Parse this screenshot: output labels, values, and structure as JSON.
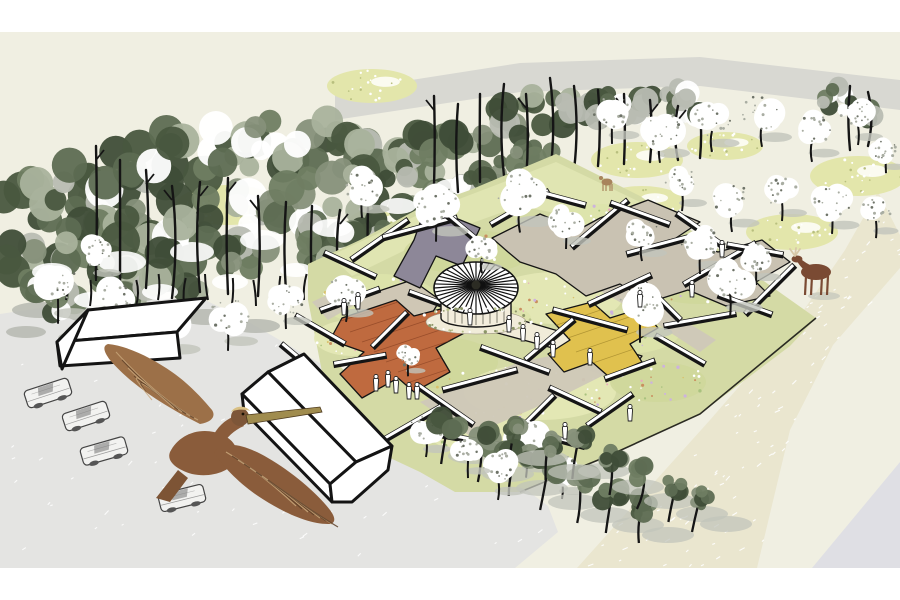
{
  "palette": {
    "page_bg": "#ffffff",
    "ground_cream": "#f0efe2",
    "back_road_gray": "#d8d8d2",
    "road_beige": "#eae6cf",
    "corner_gray": "#dfdfe4",
    "parking_gray": "#e4e4e2",
    "shadow_gray": "#b6b9b0",
    "tree_shadow": "#c2c4bb",
    "forest_greens": [
      "#49573f",
      "#5d6b52",
      "#6f7d62",
      "#86907a",
      "#3f4d38"
    ],
    "forest_light": "#a9b29c",
    "forest_white": "#ffffff",
    "forest_gray": "#b8bcb2",
    "trunk_black": "#151515",
    "mound_green": "#e3e6ab",
    "mound_dot_dark": "#b8bf7e",
    "garden_green": "#d4daa5",
    "garden_north_band": "#e0e5b2",
    "garden_edge_dark": "#2a2a22",
    "bed_patches": [
      "#dde3ab",
      "#cfd79b",
      "#e4e8b6"
    ],
    "flower_dots": [
      "#ffffff",
      "#cdb3dd",
      "#e8a9bd",
      "#ffffff",
      "#d9c16a",
      "#a9c27f",
      "#ffffff",
      "#c98f5f"
    ],
    "path_taupe": "#cfc8b8",
    "path_cream": "#f1ecd9",
    "path_white": "#f6f4ea",
    "platform_slate": "#8d8798",
    "platform_orange": "#bf6a3f",
    "plank_line": "#8d4526",
    "platform_beige": "#cfc7b5",
    "canopy_taupe": "#c9c2b2",
    "platform_yellow": "#e0c14e",
    "yellow_line": "#a68b2e",
    "platform_salmon1": "#e9b7a9",
    "platform_salmon2": "#f0c9bc",
    "pavilion_wall": "#f3eddc",
    "barn_white": "#ffffff",
    "outline_black": "#141414",
    "car_body": "#f2f2f0",
    "car_detail": "#777777",
    "person_fill": "#ffffff",
    "person_stroke": "#222222",
    "pelican_main": "#8a5c3b",
    "pelican_wing_up": "#9c7048",
    "pelican_wing_light": "#c9a87c",
    "pelican_dark": "#5e4028",
    "pelican_tail": "#7d5435",
    "pelican_head": "#7d5638",
    "pelican_crown": "#d9c084",
    "pelican_bill": "#a08c4e",
    "moose_brown": "#7a4a33",
    "antler_tan": "#d8c8a8",
    "deer_brown": "#a8845c"
  },
  "scene": {
    "bands": {
      "top_white": [
        0,
        0,
        900,
        32
      ],
      "bottom_white": [
        0,
        568,
        900,
        32
      ]
    },
    "polys": {
      "back_road": "335,92 520,63 700,57 900,80 900,110 700,86 520,92 335,120",
      "main_road": "878,192 900,235 900,268 833,345 790,430 757,568 577,568 710,420 797,320 845,250",
      "corner_wedge": "900,462 900,568 812,568",
      "parking_lot": "0,314 120,296 205,300 242,318 300,352 365,388 432,426 500,470 548,506 558,532 515,568 0,568",
      "garden_base": "308,264 360,240 420,208 470,190 556,154 640,196 720,250 816,318 790,346 700,414 608,456 520,492 455,492 420,472 356,442 322,372 308,300",
      "garden_north_band": "330,256 420,214 556,162 640,202 600,222 520,206 430,238 352,276",
      "garden_edge": "816,318 700,414 608,456 520,492",
      "path1": "420,402 520,362 600,346 642,356 562,396 470,436",
      "path2": "548,246 600,272 664,308 716,340 700,352 648,318 588,284 536,258",
      "path3": "312,302 354,282 370,296 328,320",
      "path_cream": "500,314 596,342 642,356 632,370 582,356 494,332",
      "path_white": "340,366 404,340 428,356 364,392",
      "slate": "426,206 480,228 462,266 436,256 420,288 394,276 414,240",
      "taupe_canopy": "492,238 540,214 578,230 600,218 648,200 700,222 676,238 718,252 762,240 790,262 756,282 770,296 726,306 688,290 650,302 620,284 586,296 556,274 520,262 508,252",
      "orange_deck": "342,318 396,300 414,316 452,306 470,330 436,348 450,372 414,392 398,378 362,398 340,374 364,352 330,340",
      "beige_platform": "352,300 412,280 440,300 428,320 396,332 402,346 372,358 344,336 362,320",
      "yellow_platform": "546,314 592,302 610,318 642,308 658,328 630,344 642,362 608,376 592,362 564,372 548,354 570,340",
      "salmon1": "560,236 588,226 600,240 572,250",
      "salmon2": "612,252 636,244 646,256 622,264"
    },
    "forest_clusters": [
      [
        30,
        205,
        46
      ],
      [
        78,
        188,
        48
      ],
      [
        128,
        172,
        46
      ],
      [
        178,
        158,
        46
      ],
      [
        228,
        150,
        44
      ],
      [
        278,
        146,
        44
      ],
      [
        326,
        146,
        42
      ],
      [
        370,
        152,
        40
      ],
      [
        30,
        262,
        44
      ],
      [
        84,
        246,
        46
      ],
      [
        140,
        232,
        46
      ],
      [
        196,
        220,
        44
      ],
      [
        250,
        210,
        44
      ],
      [
        304,
        202,
        42
      ],
      [
        352,
        190,
        40
      ],
      [
        50,
        298,
        40
      ],
      [
        115,
        285,
        42
      ],
      [
        180,
        272,
        42
      ],
      [
        245,
        258,
        40
      ],
      [
        308,
        246,
        38
      ],
      [
        358,
        232,
        36
      ],
      [
        398,
        170,
        38
      ],
      [
        436,
        150,
        38
      ],
      [
        474,
        132,
        36
      ],
      [
        512,
        118,
        36
      ],
      [
        550,
        108,
        34
      ],
      [
        588,
        102,
        34
      ],
      [
        626,
        98,
        32
      ],
      [
        662,
        100,
        32
      ],
      [
        696,
        106,
        30
      ],
      [
        404,
        218,
        34
      ],
      [
        448,
        196,
        32
      ],
      [
        492,
        176,
        30
      ],
      [
        534,
        160,
        28
      ],
      [
        864,
        118,
        26
      ],
      [
        836,
        100,
        24
      ]
    ],
    "snow_patches": [
      [
        52,
        272,
        20,
        9
      ],
      [
        122,
        262,
        24,
        11
      ],
      [
        192,
        252,
        22,
        10
      ],
      [
        262,
        240,
        22,
        10
      ],
      [
        332,
        228,
        20,
        9
      ],
      [
        398,
        206,
        18,
        8
      ],
      [
        452,
        186,
        16,
        7
      ],
      [
        92,
        300,
        18,
        8
      ],
      [
        160,
        292,
        18,
        8
      ],
      [
        230,
        282,
        18,
        8
      ],
      [
        296,
        270,
        16,
        7
      ]
    ],
    "tall_trunks": [
      [
        96,
        278,
        146
      ],
      [
        120,
        296,
        160
      ],
      [
        146,
        288,
        170
      ],
      [
        172,
        298,
        186
      ],
      [
        200,
        292,
        182
      ],
      [
        228,
        294,
        178
      ],
      [
        258,
        296,
        196
      ],
      [
        286,
        292,
        202
      ],
      [
        312,
        288,
        206
      ],
      [
        340,
        282,
        210
      ],
      [
        368,
        272,
        208
      ],
      [
        434,
        186,
        96
      ],
      [
        458,
        192,
        104
      ],
      [
        480,
        182,
        94
      ],
      [
        504,
        176,
        84
      ],
      [
        526,
        180,
        94
      ],
      [
        550,
        174,
        78
      ],
      [
        574,
        170,
        86
      ],
      [
        598,
        166,
        90
      ],
      [
        624,
        164,
        94
      ],
      [
        650,
        162,
        100
      ],
      [
        678,
        160,
        106
      ],
      [
        700,
        158,
        112
      ],
      [
        850,
        150,
        86
      ],
      [
        868,
        146,
        92
      ]
    ],
    "floor_trunks": [
      [
        66,
        300
      ],
      [
        90,
        306
      ],
      [
        112,
        300
      ],
      [
        136,
        306
      ],
      [
        158,
        300
      ],
      [
        184,
        304
      ],
      [
        208,
        300
      ],
      [
        232,
        304
      ],
      [
        256,
        306
      ],
      [
        280,
        302
      ],
      [
        304,
        300
      ],
      [
        328,
        296
      ]
    ],
    "lot_shadows": [
      [
        40,
        310,
        28,
        8
      ],
      [
        96,
        314,
        30,
        9
      ],
      [
        152,
        310,
        28,
        8
      ],
      [
        206,
        317,
        26,
        8
      ],
      [
        256,
        326,
        24,
        7
      ],
      [
        26,
        332,
        20,
        6
      ],
      [
        80,
        338,
        22,
        7
      ],
      [
        134,
        334,
        20,
        6
      ]
    ],
    "mounds": [
      [
        228,
        205,
        52,
        20
      ],
      [
        372,
        86,
        45,
        17
      ],
      [
        386,
        223,
        38,
        16
      ],
      [
        637,
        160,
        46,
        18
      ],
      [
        642,
        202,
        42,
        16
      ],
      [
        725,
        146,
        38,
        14
      ],
      [
        858,
        176,
        48,
        20
      ],
      [
        792,
        232,
        46,
        18
      ],
      [
        700,
        262,
        36,
        14
      ],
      [
        560,
        205,
        26,
        12
      ]
    ],
    "beds": [
      [
        380,
        300,
        58,
        26
      ],
      [
        468,
        252,
        64,
        22
      ],
      [
        556,
        298,
        66,
        26
      ],
      [
        640,
        262,
        64,
        24
      ],
      [
        432,
        362,
        66,
        26
      ],
      [
        540,
        392,
        76,
        28
      ],
      [
        624,
        332,
        56,
        22
      ],
      [
        700,
        284,
        56,
        20
      ],
      [
        352,
        338,
        38,
        18
      ],
      [
        600,
        222,
        46,
        18
      ],
      [
        658,
        382,
        48,
        20
      ],
      [
        484,
        432,
        56,
        22
      ],
      [
        476,
        318,
        55,
        16
      ]
    ],
    "beams": [
      [
        380,
        240,
        70,
        -35
      ],
      [
        350,
        265,
        58,
        25
      ],
      [
        420,
        228,
        78,
        -15
      ],
      [
        455,
        222,
        54,
        40
      ],
      [
        520,
        208,
        68,
        -30
      ],
      [
        558,
        198,
        58,
        15
      ],
      [
        600,
        224,
        74,
        -40
      ],
      [
        640,
        214,
        64,
        20
      ],
      [
        665,
        244,
        80,
        -15
      ],
      [
        700,
        230,
        58,
        35
      ],
      [
        720,
        264,
        84,
        -30
      ],
      [
        755,
        250,
        58,
        10
      ],
      [
        770,
        290,
        70,
        -45
      ],
      [
        745,
        305,
        58,
        20
      ],
      [
        700,
        320,
        74,
        -10
      ],
      [
        660,
        300,
        58,
        45
      ],
      [
        620,
        290,
        70,
        -25
      ],
      [
        590,
        320,
        78,
        15
      ],
      [
        550,
        340,
        64,
        -40
      ],
      [
        515,
        360,
        74,
        20
      ],
      [
        480,
        380,
        78,
        -15
      ],
      [
        445,
        405,
        70,
        35
      ],
      [
        410,
        425,
        74,
        -30
      ],
      [
        470,
        440,
        64,
        10
      ],
      [
        530,
        420,
        70,
        -45
      ],
      [
        575,
        400,
        58,
        25
      ],
      [
        350,
        300,
        64,
        -20
      ],
      [
        320,
        330,
        58,
        30
      ],
      [
        390,
        330,
        50,
        -45
      ],
      [
        430,
        300,
        46,
        20
      ],
      [
        360,
        360,
        54,
        -10
      ],
      [
        300,
        360,
        50,
        40
      ],
      [
        630,
        370,
        54,
        -20
      ],
      [
        680,
        350,
        58,
        30
      ],
      [
        610,
        410,
        56,
        -35
      ],
      [
        560,
        440,
        52,
        15
      ]
    ],
    "white_trees": [
      [
        58,
        286,
        26
      ],
      [
        112,
        300,
        24
      ],
      [
        168,
        322,
        26
      ],
      [
        228,
        316,
        24
      ],
      [
        286,
        300,
        20
      ],
      [
        96,
        252,
        20
      ],
      [
        362,
        186,
        22
      ],
      [
        436,
        204,
        26
      ],
      [
        520,
        192,
        28
      ],
      [
        566,
        220,
        20
      ],
      [
        612,
        112,
        22
      ],
      [
        660,
        128,
        24
      ],
      [
        712,
        120,
        22
      ],
      [
        762,
        112,
        24
      ],
      [
        812,
        130,
        22
      ],
      [
        858,
        116,
        20
      ],
      [
        886,
        150,
        16
      ],
      [
        682,
        182,
        20
      ],
      [
        732,
        200,
        22
      ],
      [
        782,
        192,
        20
      ],
      [
        832,
        202,
        22
      ],
      [
        876,
        212,
        18
      ],
      [
        642,
        232,
        20
      ],
      [
        700,
        242,
        22
      ],
      [
        756,
        256,
        20
      ],
      [
        346,
        290,
        22
      ],
      [
        408,
        356,
        14
      ],
      [
        426,
        428,
        20
      ],
      [
        526,
        440,
        26
      ],
      [
        562,
        470,
        20
      ],
      [
        640,
        305,
        26
      ],
      [
        730,
        280,
        26
      ],
      [
        482,
        250,
        16
      ]
    ],
    "row_trees": [
      [
        448,
        424,
        22
      ],
      [
        482,
        440,
        24
      ],
      [
        516,
        454,
        24
      ],
      [
        548,
        468,
        24
      ],
      [
        580,
        482,
        23
      ],
      [
        612,
        494,
        21
      ],
      [
        642,
        506,
        19
      ],
      [
        578,
        442,
        19
      ],
      [
        612,
        458,
        19
      ],
      [
        644,
        472,
        19
      ],
      [
        676,
        486,
        18
      ],
      [
        700,
        498,
        16
      ],
      [
        516,
        430,
        18
      ],
      [
        548,
        444,
        18
      ]
    ],
    "row_white_trees": [
      [
        498,
        468,
        22
      ],
      [
        468,
        452,
        18
      ]
    ],
    "cars": [
      [
        48,
        393,
        -18
      ],
      [
        86,
        416,
        -18
      ],
      [
        104,
        451,
        -16
      ],
      [
        182,
        498,
        -14
      ]
    ],
    "people": [
      [
        344,
        314
      ],
      [
        358,
        308
      ],
      [
        376,
        390
      ],
      [
        388,
        386
      ],
      [
        396,
        392
      ],
      [
        409,
        398
      ],
      [
        417,
        398
      ],
      [
        470,
        324
      ],
      [
        509,
        331
      ],
      [
        523,
        340
      ],
      [
        537,
        348
      ],
      [
        553,
        356
      ],
      [
        590,
        364
      ],
      [
        640,
        306
      ],
      [
        692,
        296
      ],
      [
        722,
        256
      ],
      [
        565,
        438
      ],
      [
        630,
        420
      ]
    ],
    "pavilion": {
      "cx": 476,
      "cy": 288,
      "rx": 42,
      "ry": 26,
      "wall_top": 296,
      "wall_bottom": 318,
      "wall_rx": 35,
      "stripes": 40
    },
    "speckles": {
      "road_count": 90,
      "lot_count": 70
    },
    "deer": [
      607,
      182
    ],
    "moose": [
      816,
      270
    ]
  }
}
